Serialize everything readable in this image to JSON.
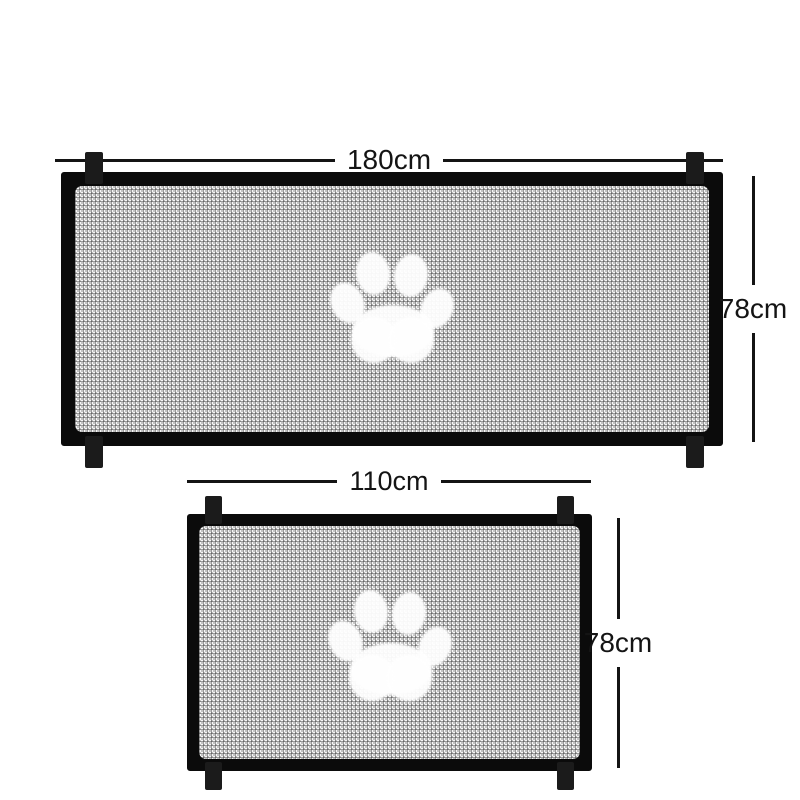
{
  "image": {
    "background": "#ffffff",
    "colors": {
      "frame": "#0b0b0b",
      "strap": "#1b1b1b",
      "mesh_light": "#f7f7f7",
      "mesh_mid": "#c2c2c2",
      "mesh_dark": "#505050",
      "paw_print": "#ffffff",
      "dimension_line": "#141414"
    }
  },
  "gates": [
    {
      "name": "large-gate",
      "icon": "paw-print-icon",
      "width_label": "180cm",
      "height_label": "78cm"
    },
    {
      "name": "small-gate",
      "icon": "paw-print-icon",
      "width_label": "110cm",
      "height_label": "78cm"
    }
  ]
}
